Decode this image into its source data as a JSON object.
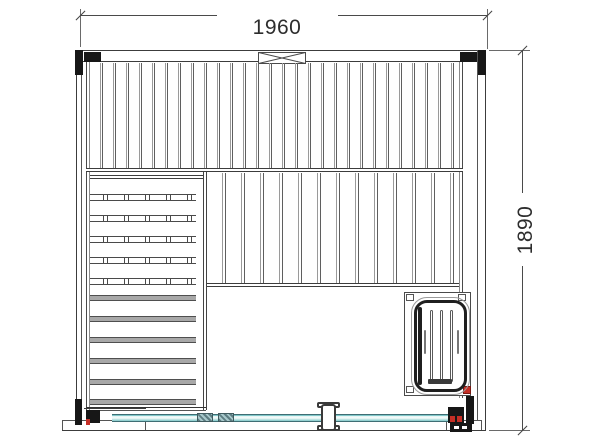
{
  "drawing": {
    "type": "technical-drawing",
    "subject": "sauna-cabin-top-view",
    "width_label": "1960",
    "height_label": "1890"
  },
  "colors": {
    "line_dark": "#3c3c3c",
    "line_light": "#9a9a9a",
    "black_fill": "#171717",
    "red_accent": "#c62f26",
    "glass_fill": "#d2efee",
    "glass_edge": "#3f6e74",
    "background": "#ffffff"
  }
}
